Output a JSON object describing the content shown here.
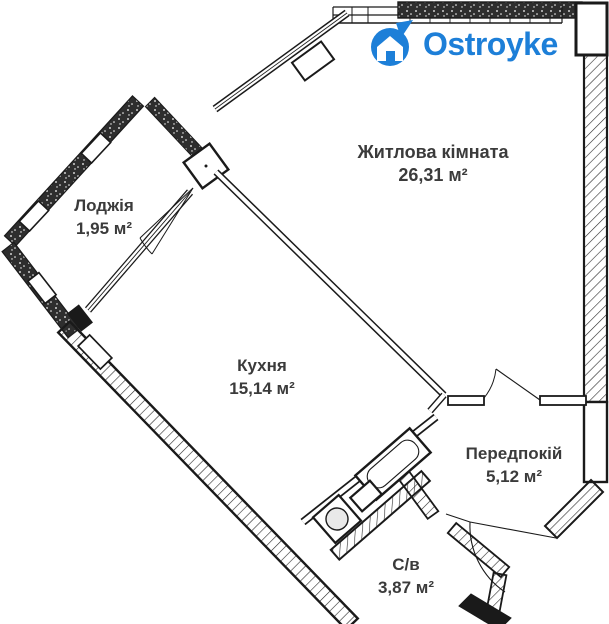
{
  "logo": {
    "text": "Ostroyke",
    "color": "#1d7fd8"
  },
  "rooms": [
    {
      "name": "Житлова кімната",
      "area": "26,31 м²"
    },
    {
      "name": "Лоджія",
      "area": "1,95 м²"
    },
    {
      "name": "Кухня",
      "area": "15,14 м²"
    },
    {
      "name": "Передпокій",
      "area": "5,12 м²"
    },
    {
      "name": "С/в",
      "area": "3,87 м²"
    }
  ],
  "colors": {
    "background": "#ffffff",
    "wall": "#1a1a1a",
    "label_text": "#3b3b3b",
    "brand_blue": "#1d7fd8"
  }
}
